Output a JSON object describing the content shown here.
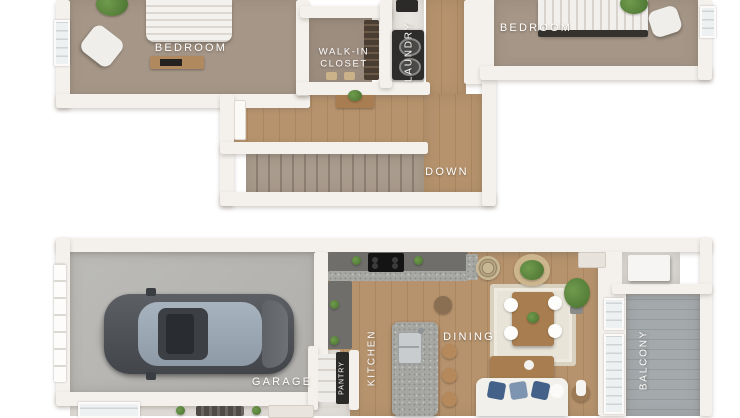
{
  "image_type": "3d-floor-plan-two-levels",
  "floors": {
    "upper": {
      "name": "upper-floor",
      "labels": {
        "bedroom_left": "BEDROOM",
        "walk_in_closet": "WALK-IN\nCLOSET",
        "laundry": "LAUNDRY",
        "bedroom_right": "BEDROOM",
        "stairs": "DOWN"
      },
      "rooms": [
        {
          "id": "bedroom-left",
          "label": "BEDROOM",
          "features": [
            "bed",
            "armchair",
            "dresser",
            "plant",
            "window"
          ]
        },
        {
          "id": "walk-in-closet",
          "label": "WALK-IN CLOSET",
          "features": [
            "shelving"
          ]
        },
        {
          "id": "laundry",
          "label": "LAUNDRY",
          "features": [
            "stacked-washer-dryer"
          ]
        },
        {
          "id": "hallway",
          "label": "",
          "features": [
            "console-table",
            "plant",
            "door"
          ]
        },
        {
          "id": "stairs",
          "label": "DOWN",
          "features": [
            "carpeted-steps"
          ]
        },
        {
          "id": "bedroom-right",
          "label": "BEDROOM",
          "features": [
            "bed",
            "armchair",
            "plant",
            "window"
          ]
        }
      ]
    },
    "lower": {
      "name": "lower-floor",
      "labels": {
        "garage": "GARAGE",
        "pantry": "PANTRY",
        "kitchen": "KITCHEN",
        "dining": "DINING",
        "balcony": "BALCONY"
      },
      "rooms": [
        {
          "id": "garage",
          "label": "GARAGE",
          "features": [
            "car",
            "garage-door"
          ]
        },
        {
          "id": "pantry",
          "label": "PANTRY",
          "features": [
            "shelves"
          ]
        },
        {
          "id": "kitchen",
          "label": "KITCHEN",
          "features": [
            "l-shaped-counter",
            "cooktop",
            "island",
            "sink",
            "bar-stools",
            "plants"
          ]
        },
        {
          "id": "dining",
          "label": "DINING",
          "features": [
            "table",
            "four-chairs",
            "rug",
            "wall-art",
            "plant"
          ]
        },
        {
          "id": "living",
          "label": "",
          "features": [
            "sofa",
            "blue-pillows",
            "coffee-table",
            "side-table"
          ]
        },
        {
          "id": "balcony",
          "label": "BALCONY",
          "features": [
            "plank-floor",
            "utility-closet",
            "water-heater"
          ]
        },
        {
          "id": "entry",
          "label": "",
          "features": [
            "doormat",
            "plants",
            "door",
            "window"
          ]
        }
      ]
    }
  },
  "colors": {
    "background": "#ffffff",
    "wall": "#f4f1ed",
    "carpet": "#a59687",
    "wood_floor": "#b6936d",
    "concrete": "#bcbbb8",
    "balcony_floor": "#a4a9ac",
    "label_text": "#ffffff",
    "cabinet": "#6f6e6a",
    "granite": "#a6a6a3",
    "car_body": "#53565b",
    "sofa": "#f1efe9",
    "pillow_blue": "#44618a",
    "pillow_light_blue": "#7e95b1",
    "table_wood": "#a87e50",
    "plant_green": "#5d8a43"
  }
}
